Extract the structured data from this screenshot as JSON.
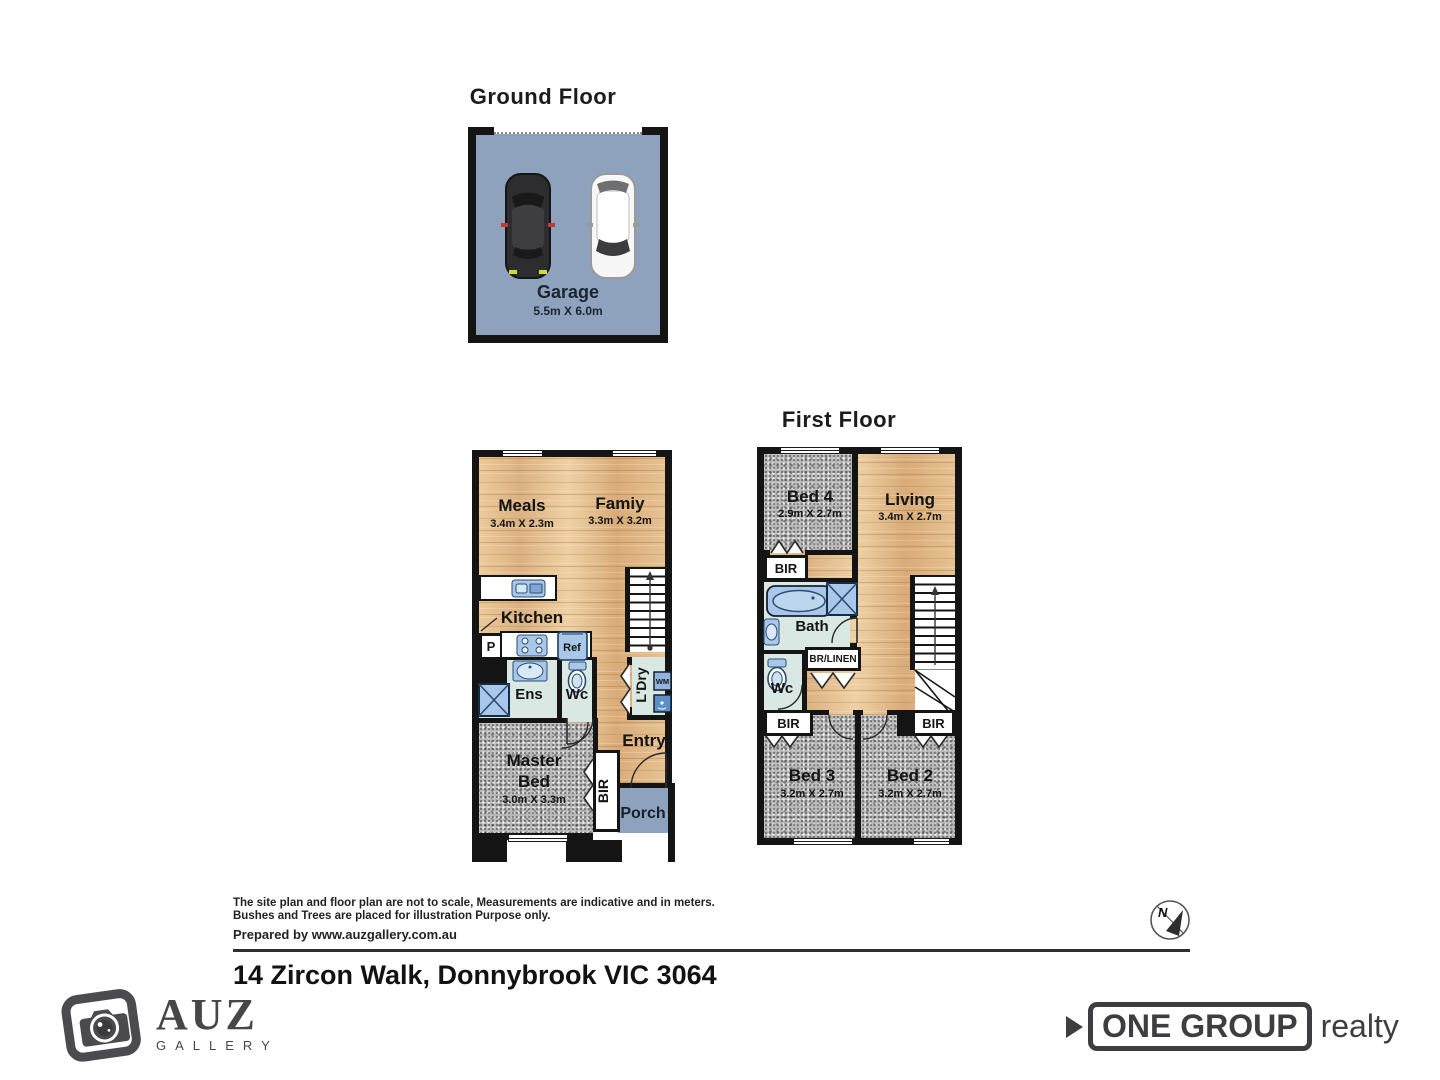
{
  "ground_floor": {
    "title": "Ground Floor",
    "garage_label": "Garage",
    "garage_dims": "5.5m X 6.0m"
  },
  "first_floor": {
    "title": "First Floor",
    "unit_left": {
      "meals_label": "Meals",
      "meals_dims": "3.4m X 2.3m",
      "family_label": "Famiy",
      "family_dims": "3.3m X 3.2m",
      "kitchen_label": "Kitchen",
      "pantry_label": "P",
      "ref_label": "Ref",
      "ens_label": "Ens",
      "wc_label": "Wc",
      "ldry_label": "L'Dry",
      "wm_label": "WM",
      "entry_label": "Entry",
      "master_label": "Master Bed",
      "master_dims": "3.0m X 3.3m",
      "bir_label": "BIR",
      "porch_label": "Porch"
    },
    "unit_right": {
      "bed4_label": "Bed 4",
      "bed4_dims": "2.9m X 2.7m",
      "living_label": "Living",
      "living_dims": "3.4m X 2.7m",
      "bir_top_label": "BIR",
      "bath_label": "Bath",
      "br_linen_label": "BR/LINEN",
      "wc_label": "Wc",
      "bir_left_label": "BIR",
      "bir_right_label": "BIR",
      "bed3_label": "Bed 3",
      "bed3_dims": "3.2m X 2.7m",
      "bed2_label": "Bed 2",
      "bed2_dims": "3.2m X 2.7m"
    }
  },
  "compass": {
    "letter": "N"
  },
  "footer": {
    "disclaimer_line1": "The site plan and floor plan are not to scale, Measurements are indicative and in meters.",
    "disclaimer_line2": "Bushes and Trees are placed for illustration Purpose only.",
    "prepared_by": "Prepared by www.auzgallery.com.au",
    "address": "14 Zircon Walk, Donnybrook VIC 3064"
  },
  "branding": {
    "auz_name": "AUZ",
    "auz_sub": "GALLERY",
    "onegroup_name": "ONE GROUP",
    "onegroup_sub": "realty"
  },
  "colors": {
    "wall": "#141414",
    "garage_fill": "#8fa2bd",
    "wood": "#e4bf91",
    "carpet": "#bbbbbb",
    "wet_floor": "#d9e8e3",
    "fixture_blue": "#a9c7e9",
    "brand_gray": "#47474a"
  }
}
